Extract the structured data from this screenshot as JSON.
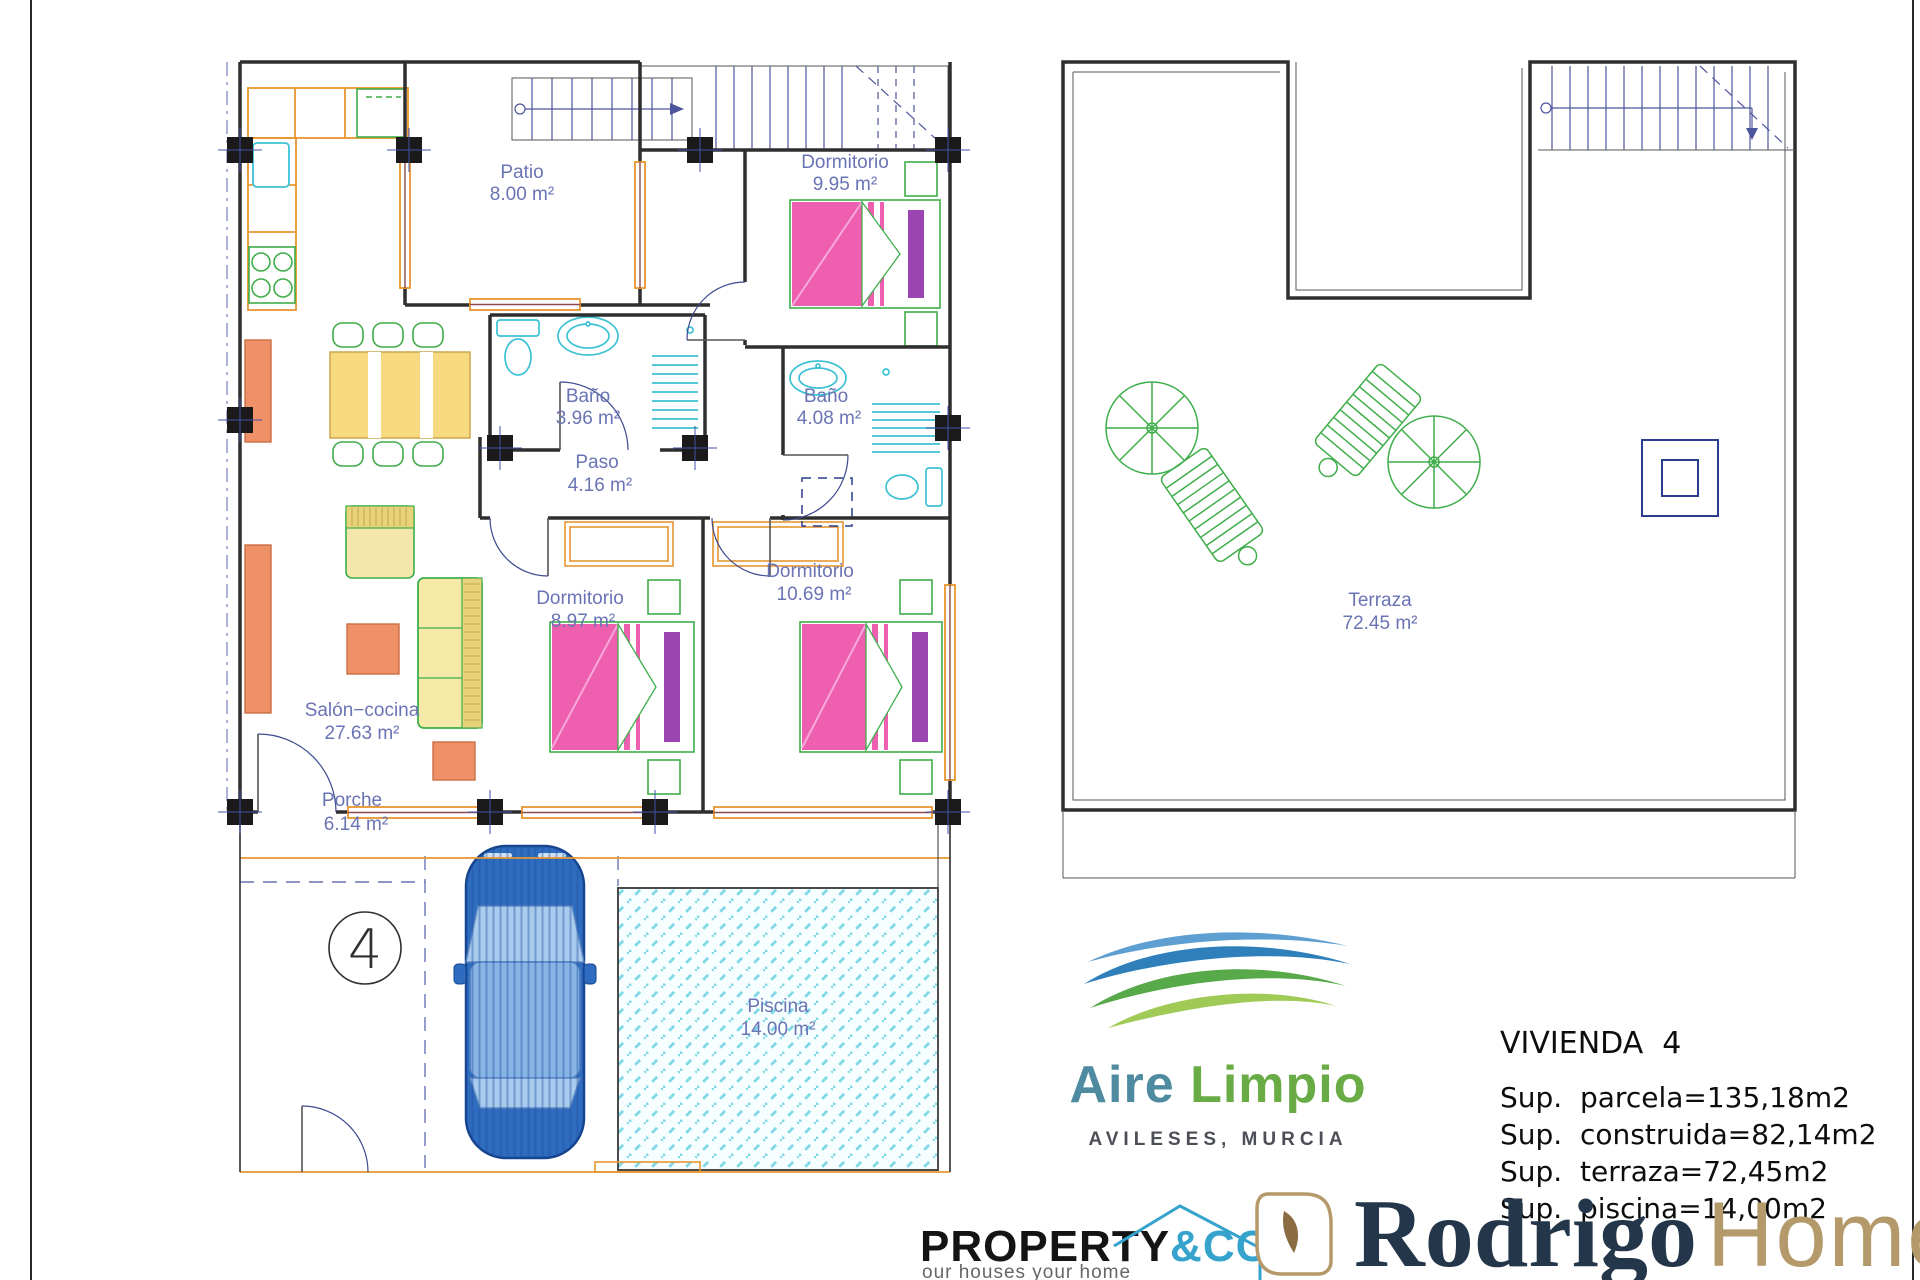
{
  "ground_floor": {
    "plot_number": "4",
    "rooms": {
      "patio": {
        "name": "Patio",
        "area": "8.00 m²"
      },
      "dormitorio_top": {
        "name": "Dormitorio",
        "area": "9.95 m²"
      },
      "bano_1": {
        "name": "Baño",
        "area": "3.96 m²"
      },
      "bano_2": {
        "name": "Baño",
        "area": "4.08 m²"
      },
      "paso": {
        "name": "Paso",
        "area": "4.16 m²"
      },
      "dormitorio_mid": {
        "name": "Dormitorio",
        "area": "8.97 m²"
      },
      "dormitorio_right": {
        "name": "Dormitorio",
        "area": "10.69 m²"
      },
      "salon": {
        "name": "Salón−cocina",
        "area": "27.63 m²"
      },
      "porche": {
        "name": "Porche",
        "area": "6.14 m²"
      },
      "piscina": {
        "name": "Piscina",
        "area": "14.00 m²"
      }
    }
  },
  "terrace_floor": {
    "terraza": {
      "name": "Terraza",
      "area": "72.45 m²"
    }
  },
  "branding": {
    "aire_limpio": {
      "word1": "Aire",
      "word2": "Limpio",
      "location": "AVILESES, MURCIA",
      "colors": {
        "blue": "#2f80ba",
        "green": "#57a94a"
      }
    },
    "specs": {
      "title": "VIVIENDA  4",
      "lines": [
        "Sup.  parcela=135,18m2",
        "Sup.  construida=82,14m2",
        "Sup.  terraza=72,45m2",
        "Sup.  piscina=14,00m2"
      ]
    },
    "property_co": {
      "word1": "PROPERTY",
      "word2": "&CO",
      "tagline": "our houses your home",
      "accent": "#35a3cc"
    },
    "rodrigo_homes": {
      "word1": "Rodrigo",
      "word2": "Homes",
      "navy": "#23364a",
      "tan": "#b49a6a"
    }
  }
}
